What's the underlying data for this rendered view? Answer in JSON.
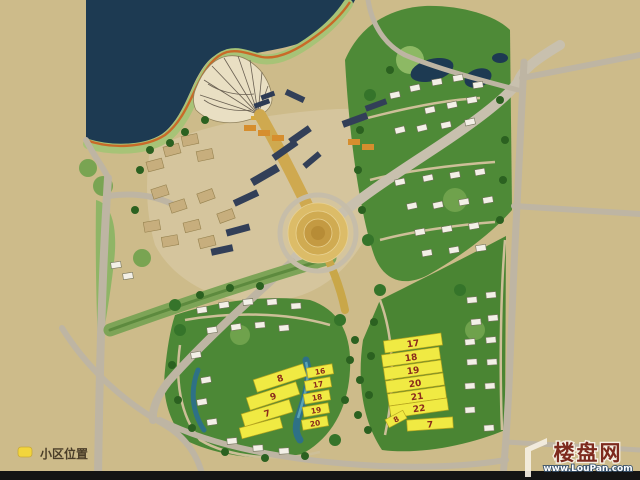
{
  "legend": {
    "label": "小区位置",
    "marker_color": "#f2d53c"
  },
  "watermark": {
    "site_name": "楼盘网",
    "site_url": "www.LouPan.com"
  },
  "clusters": {
    "left": {
      "large": [
        "8",
        "9",
        "7"
      ],
      "small": [
        "16",
        "17",
        "18",
        "19",
        "20"
      ]
    },
    "right": {
      "stack": [
        "17",
        "18",
        "19",
        "20",
        "21",
        "22"
      ],
      "bottom": [
        "8",
        "7"
      ]
    }
  },
  "colors": {
    "background": "#cdbb8a",
    "water": "#1d3a52",
    "highlight_building": "#f0ea43",
    "building_number": "#8a2b1c",
    "road": "#beb5a3",
    "green_dark": "#3f7a2e",
    "green_shore": "#a7c377",
    "shore_rim": "#c96a28",
    "bottom_bar": "#141414"
  }
}
